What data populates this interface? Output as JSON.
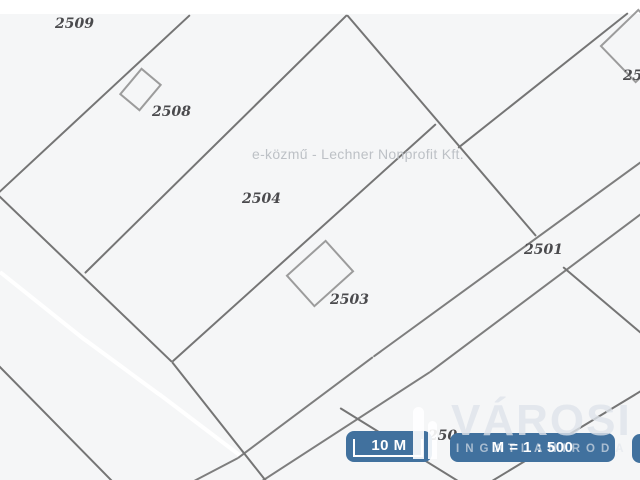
{
  "map": {
    "background_color": "#f5f6f7",
    "top_band_color": "#ffffff",
    "boundary_color": "#757575",
    "road_edge_color": "#7e7e7e",
    "building_color": "#9c9c9c",
    "white_path_color": "#ffffff",
    "watermark_text": "e-közmű - Lechner Nonprofit Kft.",
    "parcel_labels": [
      {
        "id": "parcel-label-2509",
        "text": "2509",
        "x": 55,
        "y": 16
      },
      {
        "id": "parcel-label-2508",
        "text": "2508",
        "x": 152,
        "y": 104
      },
      {
        "id": "parcel-label-2504",
        "text": "2504",
        "x": 242,
        "y": 191
      },
      {
        "id": "parcel-label-2503",
        "text": "2503",
        "x": 330,
        "y": 292
      },
      {
        "id": "parcel-label-2501",
        "text": "2501",
        "x": 524,
        "y": 242
      },
      {
        "id": "parcel-label-top-right-clipped",
        "text": "250",
        "x": 623,
        "y": 68
      },
      {
        "id": "parcel-label-bottom-clipped",
        "text": "250",
        "x": 428,
        "y": 428
      }
    ],
    "boundaries": [
      {
        "x1": 190,
        "y1": 15,
        "x2": -6,
        "y2": 197
      },
      {
        "x1": 347,
        "y1": 15,
        "x2": 85,
        "y2": 273
      },
      {
        "x1": -4,
        "y1": 193,
        "x2": 172,
        "y2": 362
      },
      {
        "x1": 172,
        "y1": 362,
        "x2": 266,
        "y2": 481
      },
      {
        "x1": 436,
        "y1": 124,
        "x2": 172,
        "y2": 362
      },
      {
        "x1": 347,
        "y1": 15,
        "x2": 536,
        "y2": 236
      },
      {
        "x1": 628,
        "y1": 13,
        "x2": 458,
        "y2": 148
      },
      {
        "x1": 563,
        "y1": 267,
        "x2": 641,
        "y2": 333
      },
      {
        "x1": 641,
        "y1": 391,
        "x2": 492,
        "y2": 481
      },
      {
        "x1": 340,
        "y1": 408,
        "x2": 458,
        "y2": 481
      },
      {
        "x1": -2,
        "y1": 365,
        "x2": 112,
        "y2": 481
      }
    ],
    "road_edges": [
      {
        "x1": 641,
        "y1": 162,
        "x2": 373,
        "y2": 357
      },
      {
        "x1": 373,
        "y1": 357,
        "x2": 238,
        "y2": 458
      },
      {
        "x1": 238,
        "y1": 458,
        "x2": 194,
        "y2": 481
      },
      {
        "x1": 641,
        "y1": 214,
        "x2": 430,
        "y2": 372
      },
      {
        "x1": 430,
        "y1": 372,
        "x2": 262,
        "y2": 481
      }
    ],
    "white_path": [
      {
        "x1": 0,
        "y1": 272,
        "x2": 85,
        "y2": 340
      },
      {
        "x1": 84,
        "y1": 339,
        "x2": 160,
        "y2": 395
      },
      {
        "x1": 159,
        "y1": 394,
        "x2": 242,
        "y2": 457
      }
    ],
    "buildings": [
      {
        "id": "building-2508",
        "cx": 138.5,
        "cy": 87.5,
        "w": 23,
        "h": 31,
        "rot": 40
      },
      {
        "id": "building-2503",
        "cx": 317.5,
        "cy": 271.5,
        "w": 50,
        "h": 39,
        "rot": -42
      },
      {
        "id": "building-top-right",
        "cx": 635,
        "cy": 44,
        "w": 48,
        "h": 50,
        "rot": 46
      }
    ]
  },
  "overlay": {
    "badge_color": "#41719e",
    "scale_badge": {
      "label": "10 M"
    },
    "ratio_badge": {
      "label": "M = 1 : 500"
    },
    "logo": {
      "title": "VÁROSI",
      "subtitle": "INGATLANIRODA"
    }
  }
}
